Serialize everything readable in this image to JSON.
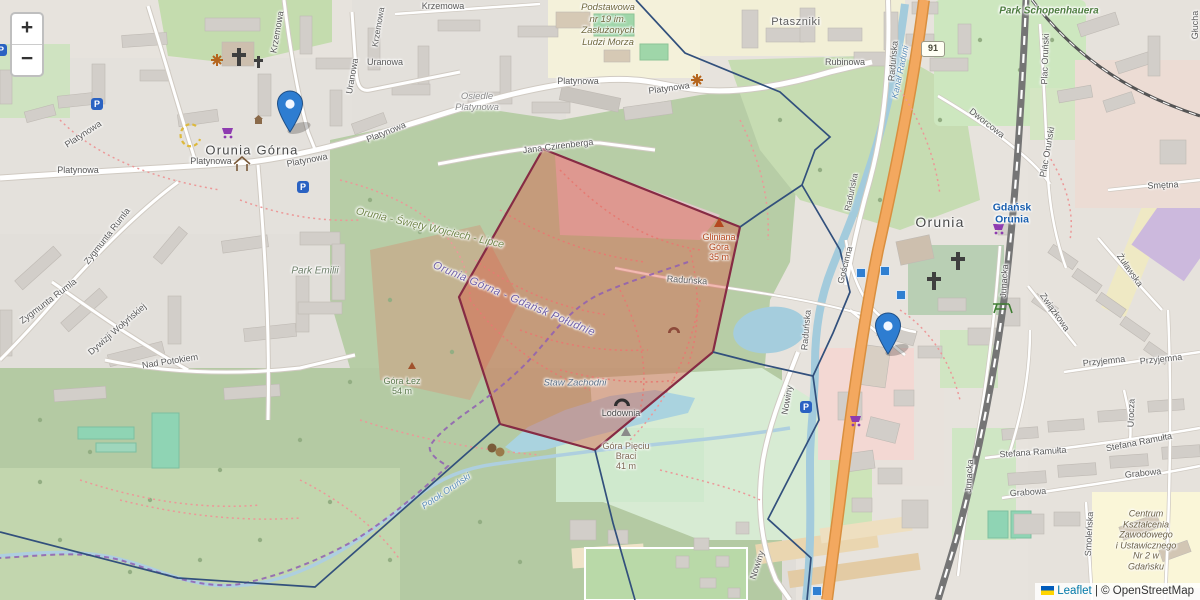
{
  "ui": {
    "zoom_in": "+",
    "zoom_out": "−",
    "route_shield": "91",
    "parking_letter": "P",
    "attribution": {
      "leaflet": "Leaflet",
      "separator": "|",
      "copyright": "© OpenStreetMap"
    }
  },
  "colors": {
    "selection_fill": "#de4a34",
    "selection_border": "#862b44",
    "boundary_navy": "#32507c",
    "admin_purple": "#8f5fb3",
    "marker_blue": "#2e7dd1",
    "water": "#aad3df",
    "trunk_road_orange": "#f3a85f",
    "attribution_link": "#0078a8"
  },
  "markers": [
    {
      "name": "marker-orunia-gorna"
    },
    {
      "name": "marker-orunia"
    }
  ],
  "labels": {
    "krzemowa_a": "Krzemowa",
    "krzemowa_b": "Krzemowa",
    "krzemowa_c": "Krzemowa",
    "uranowa_a": "Uranowa",
    "uranowa_b": "Uranowa",
    "platynowa_a": "Platynowa",
    "platynowa_b": "Platynowa",
    "platynowa_c": "Platynowa",
    "platynowa_d": "Platynowa",
    "platynowa_e": "Platynowa",
    "platynowa_f": "Platynowa",
    "platynowa_g": "Platynowa",
    "osiedle_l1": "Osiedle",
    "osiedle_l2": "Platynowa",
    "jana_czirenberga": "Jana Czirenberga",
    "zygmunta_rumla_a": "Zygmunta Rumla",
    "zygmunta_rumla_b": "Zygmunta Rumla",
    "dywizji_wolynskiej": "Dywizji Wołyńskiej",
    "nad_potokiem": "Nad Potokiem",
    "rubinowa": "Rubinowa",
    "radunska_a": "Raduńska",
    "radunska_b": "Raduńska",
    "radunska_c": "Raduńska",
    "radunska_d": "Raduńska",
    "dworcowa": "Dworcowa",
    "plac_orunski_a": "Plac Oruński",
    "plac_orunski_b": "Plac Oruński",
    "smetna": "Smętna",
    "glucha": "Głucha",
    "goscinna": "Gościnna",
    "junacka_a": "Junacka",
    "junacka_b": "Junacka",
    "zwiazkowa": "Związkowa",
    "zulawska": "Żuławska",
    "przyjemna_a": "Przyjemna",
    "przyjemna_b": "Przyjemna",
    "urocza": "Urocza",
    "stefana_ramulta_a": "Stefana Ramułta",
    "stefana_ramulta_b": "Stefana Ramułta",
    "grabowa_a": "Grabowa",
    "grabowa_b": "Grabowa",
    "smolenska": "Smoleńska",
    "nowiny_a": "Nowiny",
    "nowiny_b": "Nowiny",
    "orunia_gorna": "Orunia Górna",
    "orunia": "Orunia",
    "ptaszniki": "Ptaszniki",
    "park_schopenhauera": "Park Schopenhauera",
    "park_emilii": "Park Emilii",
    "gdansk_orunia_l1": "Gdańsk",
    "gdansk_orunia_l2": "Orunia",
    "school_l1": "Podstawowa",
    "school_l2": "nr 19 im.",
    "school_l3": "Zasłużonych",
    "school_l4": "Ludzi Morza",
    "centrum_l1": "Centrum",
    "centrum_l2": "Kształcenia",
    "centrum_l3": "Zawodowego",
    "centrum_l4": "i Ustawicznego",
    "centrum_l5": "Nr 2 w",
    "centrum_l6": "Gdańsku",
    "suburb_owsl": "Orunia - Święty Wojciech - Lipce",
    "admin_ogdp": "Orunia Górna - Gdańsk Południe",
    "gliniana_l1": "Gliniana",
    "gliniana_l2": "Góra",
    "gliniana_l3": "35 m",
    "gpb_l1": "Góra Pięciu",
    "gpb_l2": "Braci",
    "gpb_l3": "41 m",
    "goralez_l1": "Góra Łez",
    "goralez_l2": "54 m",
    "kanal_raduni": "Kanał Raduni",
    "potok_orunski": "Potok Oruński",
    "staw_zachodni": "Staw Zachodni",
    "lodownia": "Lodownia"
  }
}
